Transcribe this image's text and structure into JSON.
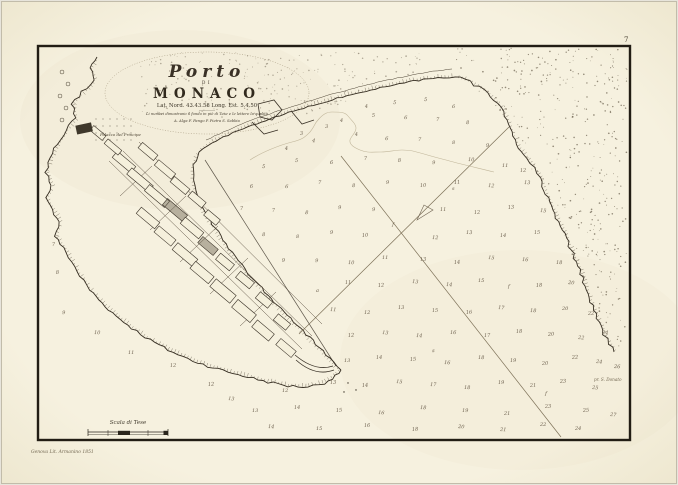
{
  "page": {
    "number": "7"
  },
  "title": {
    "porto": "Porto",
    "di": "DI",
    "monaco": "MONACO",
    "latlong": "Lat. Nord. 43.43.58  Long. Est. 5.4.50",
    "note1": "Li numeri dimostrano il fondo in piè di Tese e le lettere la qualità",
    "note2": "A. Alga   F. Fango   P. Pietra   S. Sabbia"
  },
  "labels": {
    "palazzo": "Palazzo del Principe"
  },
  "scale": {
    "label": "Scala di Tese"
  },
  "imprint": {
    "text": "Genova Lit. Armanino 1851"
  },
  "signature": {
    "text": "pr. S. Donato"
  },
  "colors": {
    "paper": "#f5f0dc",
    "ink": "#3a3226",
    "frame": "#221d14",
    "sounding": "#6e6250",
    "bearing_line": "#7d7158"
  },
  "soundings": [
    [
      365,
      108,
      "4"
    ],
    [
      393,
      104,
      "5"
    ],
    [
      424,
      101,
      "5"
    ],
    [
      452,
      108,
      "6"
    ],
    [
      340,
      122,
      "4"
    ],
    [
      372,
      117,
      "5"
    ],
    [
      404,
      119,
      "6"
    ],
    [
      436,
      121,
      "7"
    ],
    [
      466,
      124,
      "8"
    ],
    [
      325,
      128,
      "3"
    ],
    [
      300,
      135,
      "3"
    ],
    [
      355,
      136,
      "4"
    ],
    [
      385,
      140,
      "6"
    ],
    [
      418,
      141,
      "7"
    ],
    [
      452,
      144,
      "8"
    ],
    [
      486,
      147,
      "9"
    ],
    [
      285,
      150,
      "4"
    ],
    [
      312,
      142,
      "4"
    ],
    [
      262,
      168,
      "5"
    ],
    [
      295,
      162,
      "5"
    ],
    [
      330,
      164,
      "6"
    ],
    [
      364,
      160,
      "7"
    ],
    [
      398,
      162,
      "8"
    ],
    [
      432,
      164,
      "9"
    ],
    [
      468,
      161,
      "10"
    ],
    [
      502,
      167,
      "11"
    ],
    [
      520,
      172,
      "12"
    ],
    [
      250,
      188,
      "6"
    ],
    [
      285,
      188,
      "6"
    ],
    [
      318,
      184,
      "7"
    ],
    [
      352,
      187,
      "8"
    ],
    [
      386,
      184,
      "9"
    ],
    [
      420,
      187,
      "10"
    ],
    [
      454,
      184,
      "11"
    ],
    [
      488,
      187,
      "12"
    ],
    [
      524,
      184,
      "13"
    ],
    [
      452,
      190,
      "s"
    ],
    [
      240,
      210,
      "7"
    ],
    [
      272,
      212,
      "7"
    ],
    [
      305,
      214,
      "8"
    ],
    [
      338,
      209,
      "9"
    ],
    [
      372,
      211,
      "9"
    ],
    [
      440,
      211,
      "11"
    ],
    [
      474,
      214,
      "12"
    ],
    [
      508,
      209,
      "13"
    ],
    [
      540,
      212,
      "15"
    ],
    [
      262,
      236,
      "8"
    ],
    [
      296,
      238,
      "8"
    ],
    [
      330,
      234,
      "9"
    ],
    [
      362,
      237,
      "10"
    ],
    [
      392,
      226,
      "f"
    ],
    [
      432,
      239,
      "12"
    ],
    [
      466,
      234,
      "13"
    ],
    [
      500,
      237,
      "14"
    ],
    [
      534,
      234,
      "15"
    ],
    [
      282,
      262,
      "9"
    ],
    [
      315,
      262,
      "9"
    ],
    [
      348,
      264,
      "10"
    ],
    [
      382,
      259,
      "11"
    ],
    [
      420,
      261,
      "13"
    ],
    [
      454,
      264,
      "14"
    ],
    [
      488,
      259,
      "15"
    ],
    [
      522,
      261,
      "16"
    ],
    [
      556,
      264,
      "18"
    ],
    [
      316,
      292,
      "a"
    ],
    [
      345,
      284,
      "11"
    ],
    [
      378,
      287,
      "12"
    ],
    [
      412,
      283,
      "13"
    ],
    [
      446,
      286,
      "14"
    ],
    [
      478,
      282,
      "15"
    ],
    [
      508,
      288,
      "f"
    ],
    [
      536,
      287,
      "18"
    ],
    [
      568,
      284,
      "20"
    ],
    [
      330,
      311,
      "11"
    ],
    [
      364,
      314,
      "12"
    ],
    [
      398,
      309,
      "13"
    ],
    [
      432,
      312,
      "15"
    ],
    [
      466,
      314,
      "16"
    ],
    [
      498,
      309,
      "17"
    ],
    [
      530,
      312,
      "18"
    ],
    [
      562,
      310,
      "20"
    ],
    [
      588,
      315,
      "22"
    ],
    [
      348,
      337,
      "12"
    ],
    [
      382,
      334,
      "13"
    ],
    [
      416,
      337,
      "14"
    ],
    [
      450,
      334,
      "16"
    ],
    [
      484,
      337,
      "17"
    ],
    [
      516,
      333,
      "18"
    ],
    [
      548,
      336,
      "20"
    ],
    [
      578,
      339,
      "22"
    ],
    [
      602,
      334,
      "24"
    ],
    [
      344,
      362,
      "13"
    ],
    [
      376,
      359,
      "14"
    ],
    [
      410,
      361,
      "15"
    ],
    [
      432,
      352,
      "s"
    ],
    [
      444,
      364,
      "16"
    ],
    [
      478,
      359,
      "18"
    ],
    [
      510,
      362,
      "19"
    ],
    [
      542,
      365,
      "20"
    ],
    [
      572,
      359,
      "22"
    ],
    [
      596,
      363,
      "24"
    ],
    [
      614,
      368,
      "26"
    ],
    [
      282,
      392,
      "12"
    ],
    [
      330,
      384,
      "13"
    ],
    [
      362,
      387,
      "14"
    ],
    [
      396,
      383,
      "15"
    ],
    [
      430,
      386,
      "17"
    ],
    [
      464,
      389,
      "18"
    ],
    [
      498,
      384,
      "19"
    ],
    [
      530,
      387,
      "21"
    ],
    [
      560,
      383,
      "23"
    ],
    [
      592,
      389,
      "25"
    ],
    [
      545,
      395,
      "f"
    ],
    [
      252,
      412,
      "13"
    ],
    [
      294,
      409,
      "14"
    ],
    [
      336,
      412,
      "15"
    ],
    [
      378,
      414,
      "16"
    ],
    [
      420,
      409,
      "18"
    ],
    [
      462,
      412,
      "19"
    ],
    [
      504,
      415,
      "21"
    ],
    [
      545,
      408,
      "23"
    ],
    [
      583,
      412,
      "25"
    ],
    [
      610,
      416,
      "27"
    ],
    [
      268,
      428,
      "14"
    ],
    [
      316,
      430,
      "15"
    ],
    [
      364,
      427,
      "16"
    ],
    [
      412,
      431,
      "18"
    ],
    [
      458,
      428,
      "20"
    ],
    [
      500,
      431,
      "21"
    ],
    [
      540,
      426,
      "22"
    ],
    [
      575,
      430,
      "24"
    ],
    [
      52,
      246,
      "7"
    ],
    [
      56,
      274,
      "8"
    ],
    [
      62,
      314,
      "9"
    ],
    [
      94,
      334,
      "10"
    ],
    [
      128,
      354,
      "11"
    ],
    [
      170,
      367,
      "12"
    ],
    [
      208,
      386,
      "12"
    ],
    [
      228,
      400,
      "13"
    ]
  ]
}
